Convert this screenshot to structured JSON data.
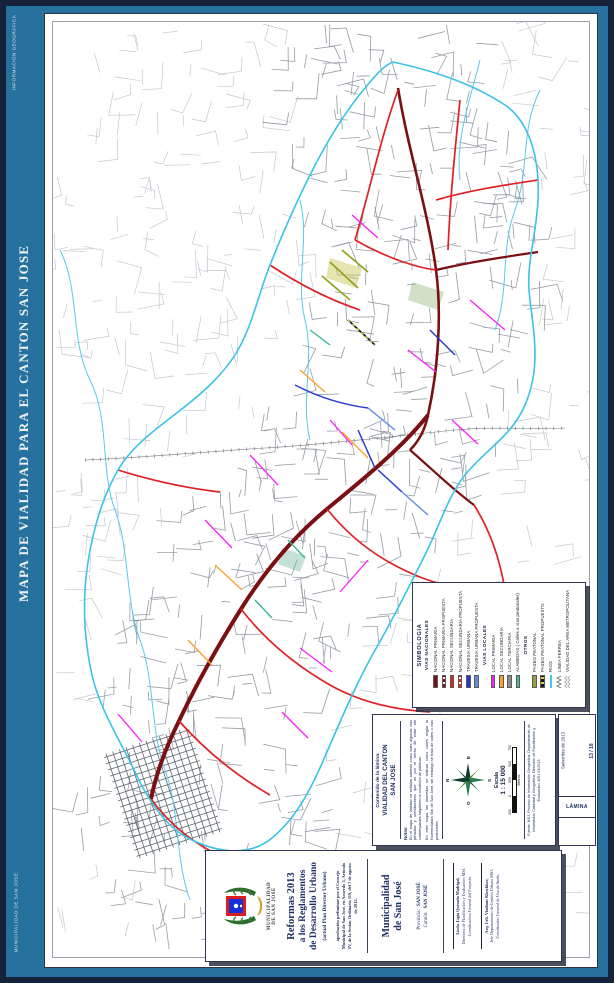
{
  "frame": {
    "side_title": "MAPA DE VIALIDAD PARA EL CANTON SAN JOSE",
    "top_label": "INFORMACIÓN GEOGRÁFICA",
    "bottom_label": "MUNICIPALIDAD DE SAN JOSÉ",
    "accent_blue": "#26719d",
    "border_navy": "#15223a"
  },
  "legend": {
    "title": "SIMBOLOGIA",
    "groups": [
      {
        "name": "VIAS NACIONALES",
        "items": [
          {
            "label": "NACIONAL PRIMARIA",
            "style": "solid",
            "color": "#7b1113"
          },
          {
            "label": "NACIONAL PRIMARIA PROPUESTA",
            "style": "dashed",
            "color": "#7b1113"
          },
          {
            "label": "NACIONAL SECUNDARIA",
            "style": "solid",
            "color": "#e8201f"
          },
          {
            "label": "NACIONAL SECUNDARIA PROPUESTA",
            "style": "dashed",
            "color": "#e8201f"
          },
          {
            "label": "TRAVESIA URBANA",
            "style": "solid",
            "color": "#2733cf"
          },
          {
            "label": "TRAVESIA URBANA PROPUESTA",
            "style": "solid",
            "color": "#5f8be4"
          }
        ]
      },
      {
        "name": "VIAS LOCALES",
        "items": [
          {
            "label": "LOCAL PRIMARIA",
            "style": "solid",
            "color": "#fb1ffb"
          },
          {
            "label": "LOCAL SECUNDARIA",
            "style": "solid",
            "color": "#fda124"
          },
          {
            "label": "LOCAL TERCIARIA",
            "style": "solid",
            "color": "#8b8b8b"
          },
          {
            "label": "ALAMEDAS  ( Calles o vías peatonales)",
            "style": "solid",
            "color": "#45bd92"
          }
        ]
      },
      {
        "name": "OTROS",
        "items": [
          {
            "label": "PASEO PEATONAL",
            "style": "solid",
            "color": "#93a23a"
          },
          {
            "label": "PASEO PEATONAL PROPUESTO",
            "style": "dashed",
            "color": "#151515",
            "alt": "#e3cf3e"
          },
          {
            "label": "RIOS",
            "style": "line",
            "color": "#44c6ee"
          },
          {
            "label": "LINEA FERREA",
            "style": "rail",
            "color": "#6f6f6f"
          },
          {
            "label": "VIALIDAD DEL AREA METROPOLITANA",
            "style": "metro",
            "color": "#9b9b9b"
          }
        ]
      }
    ]
  },
  "info": {
    "contenido_label": "Contenido de la lámina:",
    "contenido": "VIALIDAD DEL CANTON SAN JOSE",
    "notas_label": "Notas:",
    "nota1": "En el mapa de vialidad se señalan además como tales algunas vías privadas y servidumbres que no por el hecho de estar ahí contempladas adquieren la condición de públicas.",
    "nota2": "En este mapa las alamedas se indican como calles según la Nomenclatura Vial de San José, sin embargo se trata de calles o vías peatonales.",
    "compass_n": "N",
    "compass_s": "S",
    "compass_e": "E",
    "compass_o": "O",
    "escala_label": "Escala",
    "escala_value": "1 : 15 000",
    "scalebar_ticks": [
      "250",
      "0",
      "250",
      "500",
      "750"
    ],
    "units": "Metros",
    "fuente": "Fuente: MSJ, Proceso de Información Geográfica, Departamento de Información Catastral y Geográfica, Dirección de Planificación y Evaluación. MSJ 03/2013."
  },
  "lamina": {
    "date": "Setiembre de 2013",
    "number": "13 / 18",
    "label": "LÁMINA"
  },
  "titleblock": {
    "org_line1": "MUNICIPALIDAD",
    "org_line2": "DE SAN JOSÉ",
    "title1": "Reformas 2013",
    "title2": "a los Reglamentos",
    "title3": "de Desarrollo Urbano",
    "subtitle": "(actual Plan Director Urbano)",
    "approval": "aprobación preliminar por el Concejo Municipal de San José, en Acuerdo 3, Artículo IV, de la Sesión Ordinaria 119, del 7 de agosto de 2012.",
    "muni1": "Municipalidad",
    "muni2": "de San José",
    "provincia_label": "Provincia:",
    "provincia": "SAN JOSÉ",
    "canton_label": "Cantón:",
    "canton": "SAN JOSÉ",
    "sig1_name": "Licda. Ligia Quesada Madrigal,",
    "sig1_role": "Directora de Planificación y Evaluación MSJ,",
    "sig1_extra": "Coordinadora General del Proyecto.",
    "sig2_name": "Arq. Urb. Vladimir Klotchkov,",
    "sig2_role": "Jefe Departamento de Gestión Urbana MSJ,",
    "sig2_extra": "Coordinador General de Uso de Suelo."
  }
}
